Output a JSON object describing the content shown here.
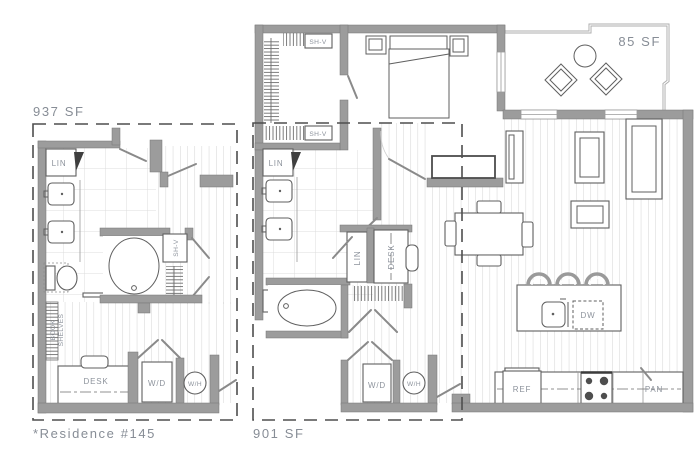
{
  "plan_title": "Apartment floor plan",
  "areas": {
    "left_unit_area": "937 SF",
    "middle_unit_area": "901 SF",
    "terrace_area": "85 SF",
    "residence_note": "*Residence #145"
  },
  "room_labels": {
    "linen": "LIN",
    "shelf": "SH-V",
    "desk": "DESK",
    "washer_dryer": "W/D",
    "water_heater": "W/H",
    "dishwasher": "DW",
    "refrigerator": "REF",
    "pantry": "PAN",
    "book": "BOOK",
    "shelves": "SHELVES"
  },
  "colors": {
    "background": "#ffffff",
    "wall": "#9c9c9c",
    "fixture_line": "#5f5f5f",
    "tile_grid": "#dcdcdc",
    "plank_line": "#d3d3d3",
    "label_text": "#8d939c",
    "dash_boundary": "#4e4e4e"
  }
}
